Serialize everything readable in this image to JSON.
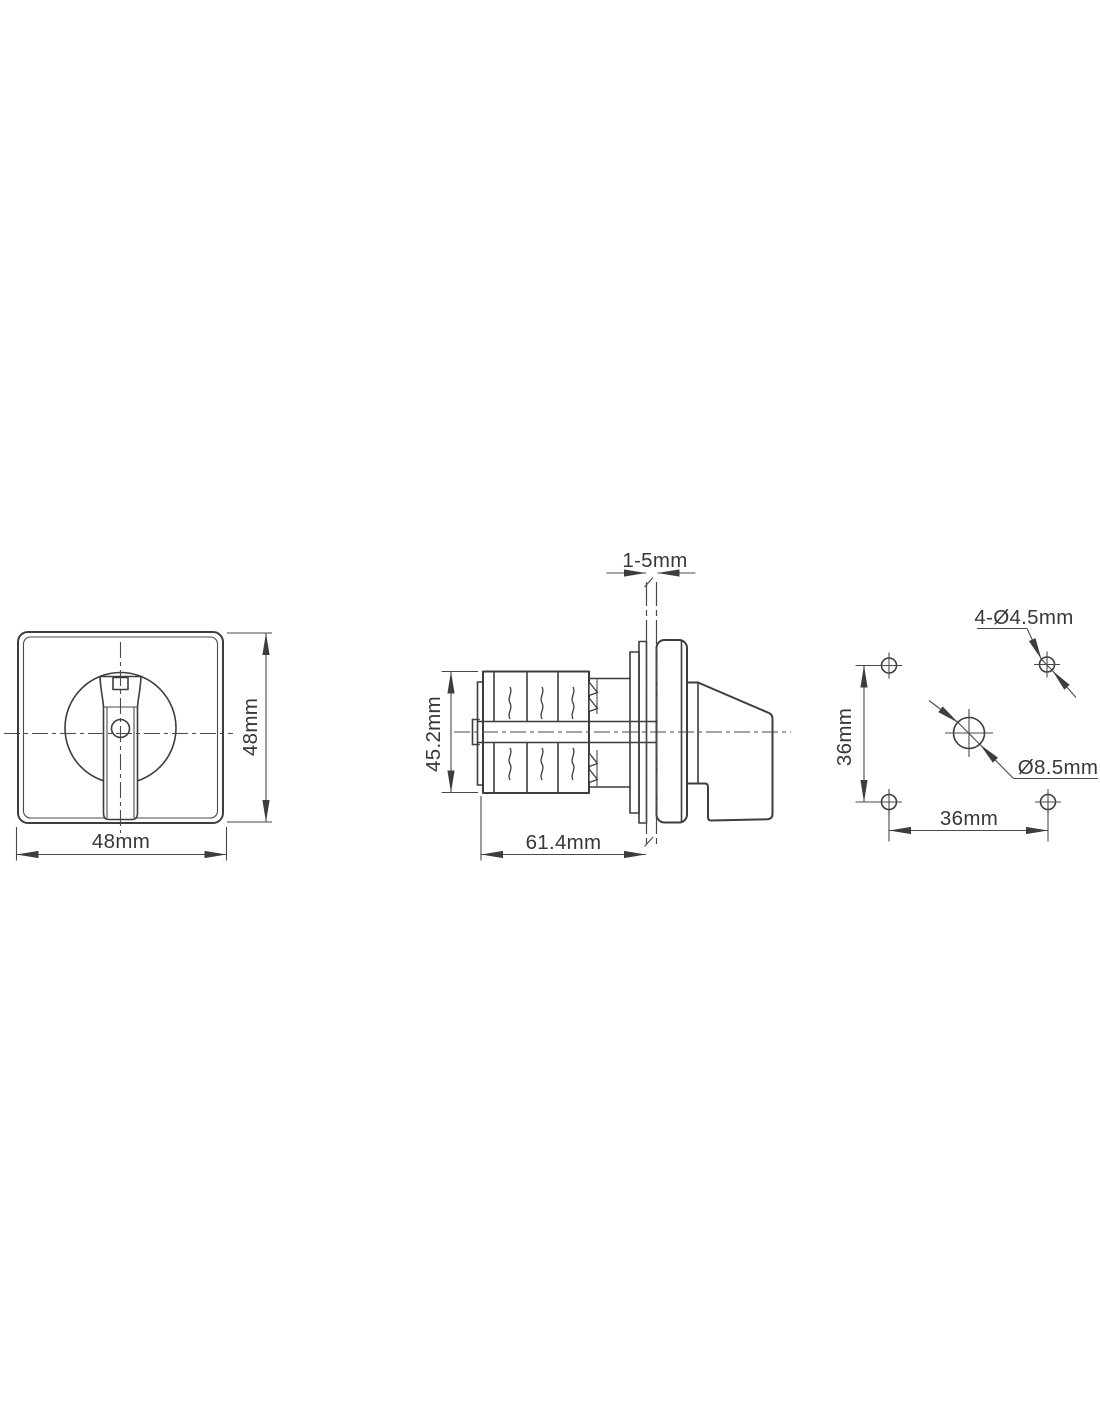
{
  "drawing": {
    "title": "cam-switch-dimension-drawing",
    "views": {
      "front": {
        "width_label": "48mm",
        "height_label": "48mm"
      },
      "side": {
        "panel_thickness_label": "1-5mm",
        "height_label": "45.2mm",
        "length_label": "61.4mm"
      },
      "mounting": {
        "corner_holes_label": "4-Ø4.5mm",
        "center_hole_label": "Ø8.5mm",
        "vertical_spacing_label": "36mm",
        "horizontal_spacing_label": "36mm"
      }
    },
    "colors": {
      "line": "#3d3d3d",
      "background": "#ffffff"
    }
  }
}
